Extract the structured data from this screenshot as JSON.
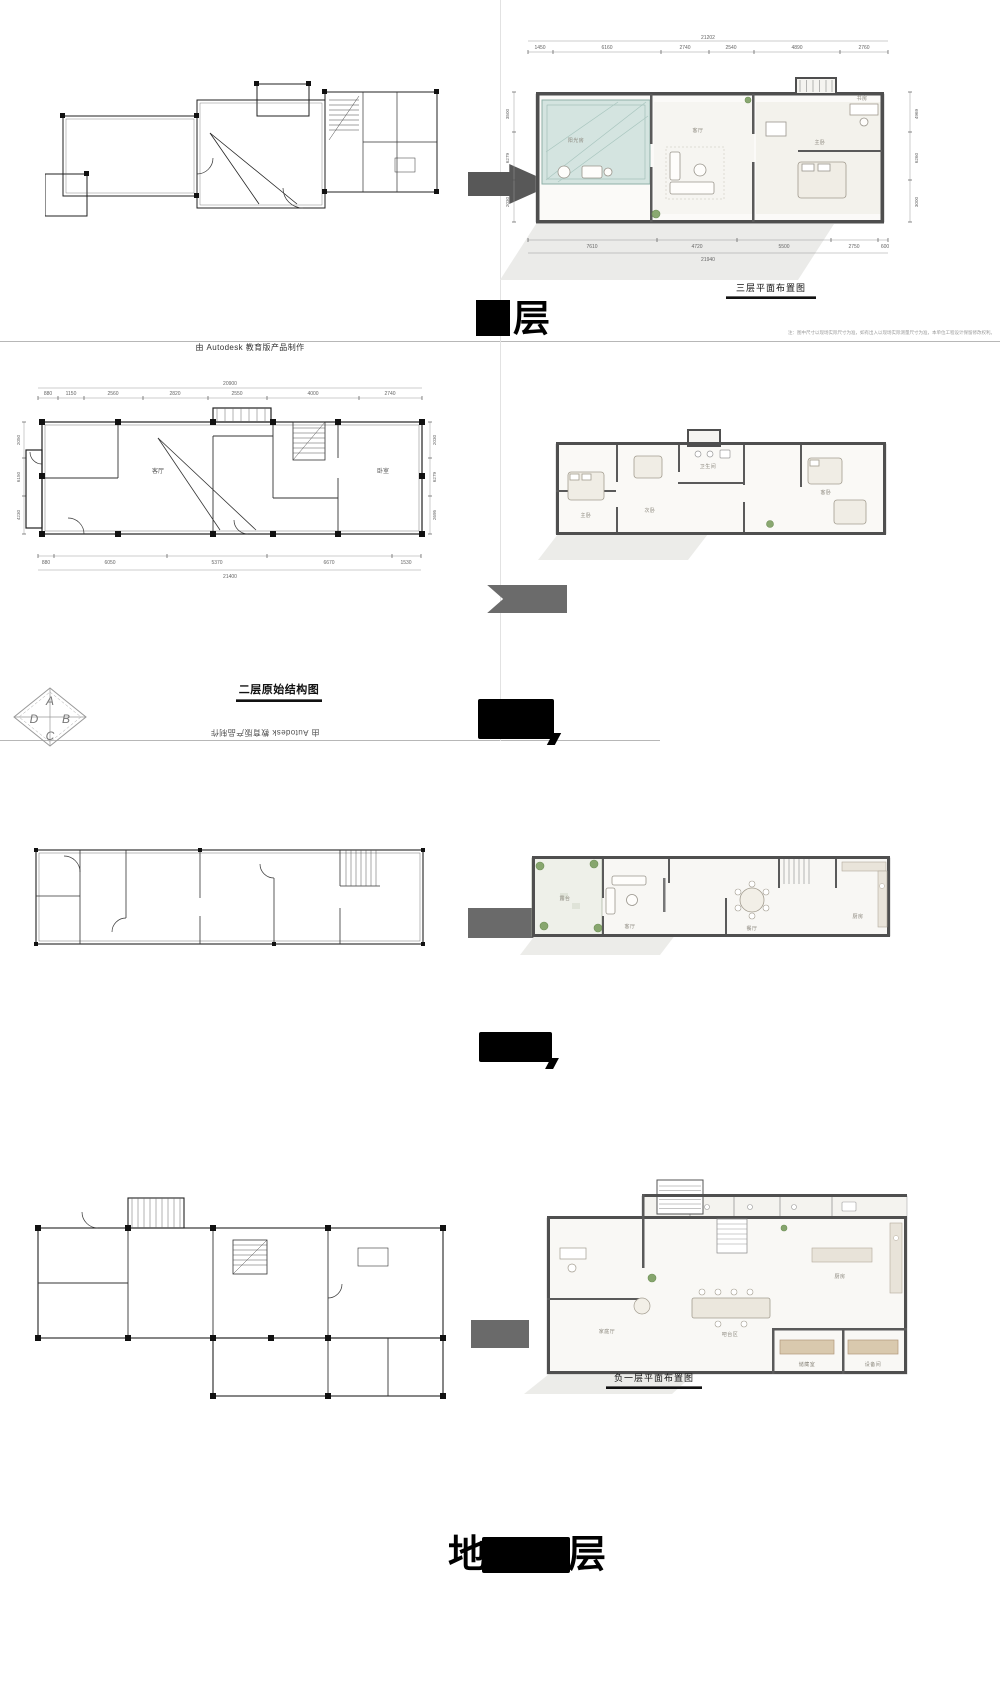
{
  "watermark": {
    "autodesk_top": "由 Autodesk 教育版产品制作",
    "autodesk_bottom": "由 Autodesk 教育版产品制作",
    "disclaimer": "注：图中尺寸以现场实际尺寸为准，如有出入以现场实际测量尺寸为准，本单位工程设计保留修改权利。"
  },
  "compass": {
    "a": "A",
    "b": "B",
    "c": "C",
    "d": "D"
  },
  "floor_labels": {
    "top": {
      "prefix": "",
      "suffix": "层"
    },
    "second": {
      "prefix": "",
      "suffix": ""
    },
    "first": {
      "prefix": "",
      "suffix": ""
    },
    "basement": {
      "prefix": "地",
      "suffix": "层"
    }
  },
  "plans": {
    "third_styled": {
      "title": "三层平面布置图",
      "dims_top": [
        "1450",
        "6160",
        "2740",
        "2540",
        "4890",
        "2760"
      ],
      "dims_top_total": "21202",
      "dims_bottom": [
        "7610",
        "4720",
        "5500",
        "2750",
        "600"
      ],
      "dims_bottom_total": "21940",
      "dims_left": [
        "3500",
        "6279",
        "2030"
      ],
      "dims_right": [
        "4969",
        "6260",
        "3000"
      ],
      "rooms": [
        "阳光房",
        "客厅",
        "主卧",
        "书房"
      ]
    },
    "second_original": {
      "title": "二层原始结构图",
      "dims_top": [
        "880",
        "1150",
        "2560",
        "2820",
        "2550",
        "4000",
        "2740"
      ],
      "dims_top_total": "20900",
      "dims_bottom": [
        "880",
        "6050",
        "5370",
        "6670",
        "1530"
      ],
      "dims_bottom_total": "21400",
      "dims_left": [
        "2050",
        "6150",
        "4230"
      ],
      "dims_right": [
        "2030",
        "6279",
        "2695"
      ],
      "rooms": [
        "客厅",
        "卧室"
      ]
    },
    "second_styled": {
      "rooms": [
        "主卧",
        "次卧",
        "卫生间",
        "客卧"
      ]
    },
    "first_styled": {
      "rooms": [
        "露台",
        "客厅",
        "餐厅",
        "厨房"
      ]
    },
    "basement_styled": {
      "title": "负一层平面布置图",
      "rooms": [
        "家庭厅",
        "吧台区",
        "厨房",
        "储藏室",
        "设备间"
      ]
    }
  }
}
